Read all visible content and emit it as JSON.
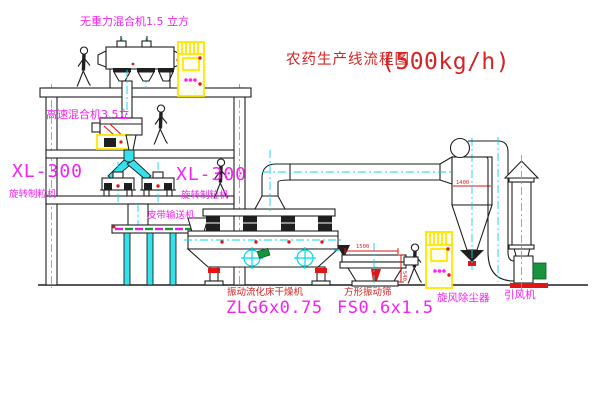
{
  "title": {
    "text": "农药生产线流程图",
    "rate": "(500kg/h)"
  },
  "labels": {
    "top_mixer": "无重力混合机1.5 立方",
    "high_speed_mixer": "高速混合机3.5立",
    "granulator_left": {
      "model": "XL-300",
      "name": "旋转制粒机"
    },
    "granulator_right": {
      "model": "XL-300",
      "name": "旋转制粒机"
    },
    "belt_conveyor": "皮带输送机",
    "dryer": {
      "name": "振动流化床干燥机",
      "model": "ZLG6x0.75"
    },
    "screen": {
      "name": "方形振动筛",
      "model": "FS0.6x1.5"
    },
    "cyclone": "旋风除尘器",
    "fan": "引风机"
  },
  "dimensions": {
    "screen_width": "1500",
    "screen_height": "540",
    "cyclone_dia": "1400"
  },
  "colors": {
    "label_magenta": "#f322f3",
    "label_red": "#d42424",
    "centerline_cyan": "#00dbe6",
    "cabinet_yellow": "#ffe800",
    "accent_red": "#e01616",
    "line_black": "#1f1f1f"
  }
}
